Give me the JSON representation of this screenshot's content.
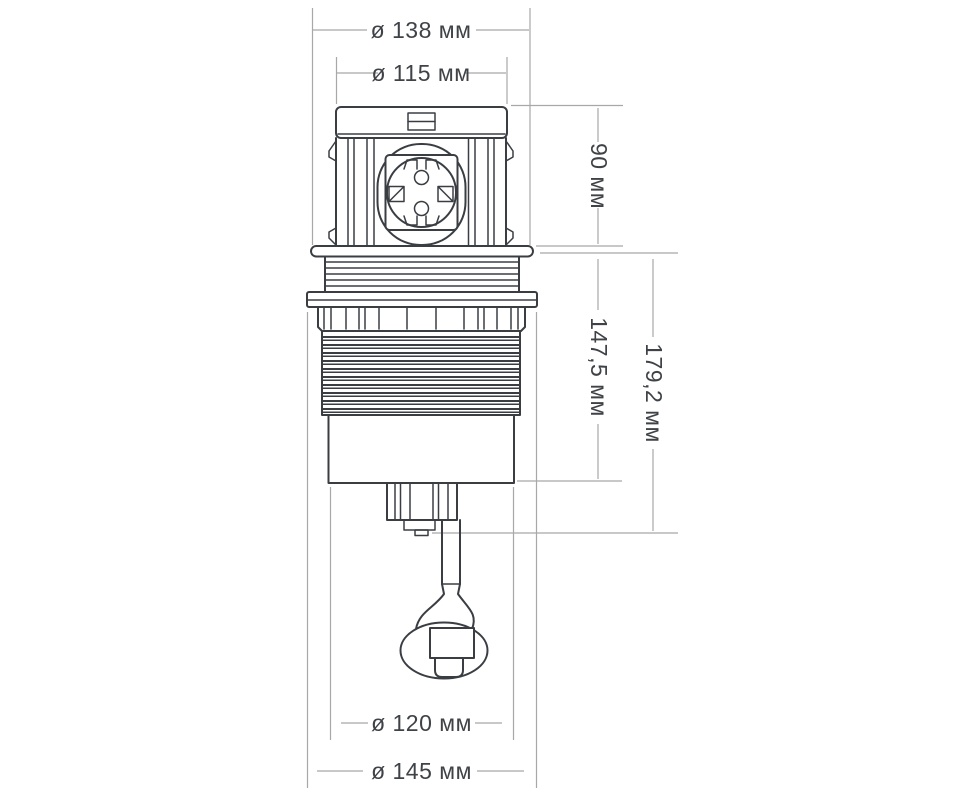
{
  "diagram": {
    "kind": "technical-dimension-drawing",
    "subject": "pop-up-socket-column-side-view",
    "units": "мм",
    "colors": {
      "background": "#ffffff",
      "outline": "#3a3e43",
      "dimension_lines": "#a8a8a8",
      "label_text": "#3f4347"
    },
    "dimensions": [
      {
        "id": "top-outer-diameter",
        "label": "ø 138 мм",
        "value": 138,
        "orientation": "horizontal",
        "refers_to": "upper collar diameter"
      },
      {
        "id": "top-cap-diameter",
        "label": "ø 115 мм",
        "value": 115,
        "orientation": "horizontal",
        "refers_to": "pop-up cap diameter"
      },
      {
        "id": "above-surface-height",
        "label": "90 мм",
        "value": 90,
        "orientation": "vertical",
        "refers_to": "height of raised block above collar"
      },
      {
        "id": "body-height",
        "label": "147,5 мм",
        "value": 147.5,
        "orientation": "vertical",
        "refers_to": "under-surface body height"
      },
      {
        "id": "total-under-height",
        "label": "179,2 мм",
        "value": 179.2,
        "orientation": "vertical",
        "refers_to": "under-surface height incl. terminal"
      },
      {
        "id": "cutout-diameter",
        "label": "ø 120 мм",
        "value": 120,
        "orientation": "horizontal",
        "refers_to": "lower cylinder diameter"
      },
      {
        "id": "flange-diameter",
        "label": "ø 145 мм",
        "value": 145,
        "orientation": "horizontal",
        "refers_to": "mounting flange diameter"
      }
    ]
  }
}
